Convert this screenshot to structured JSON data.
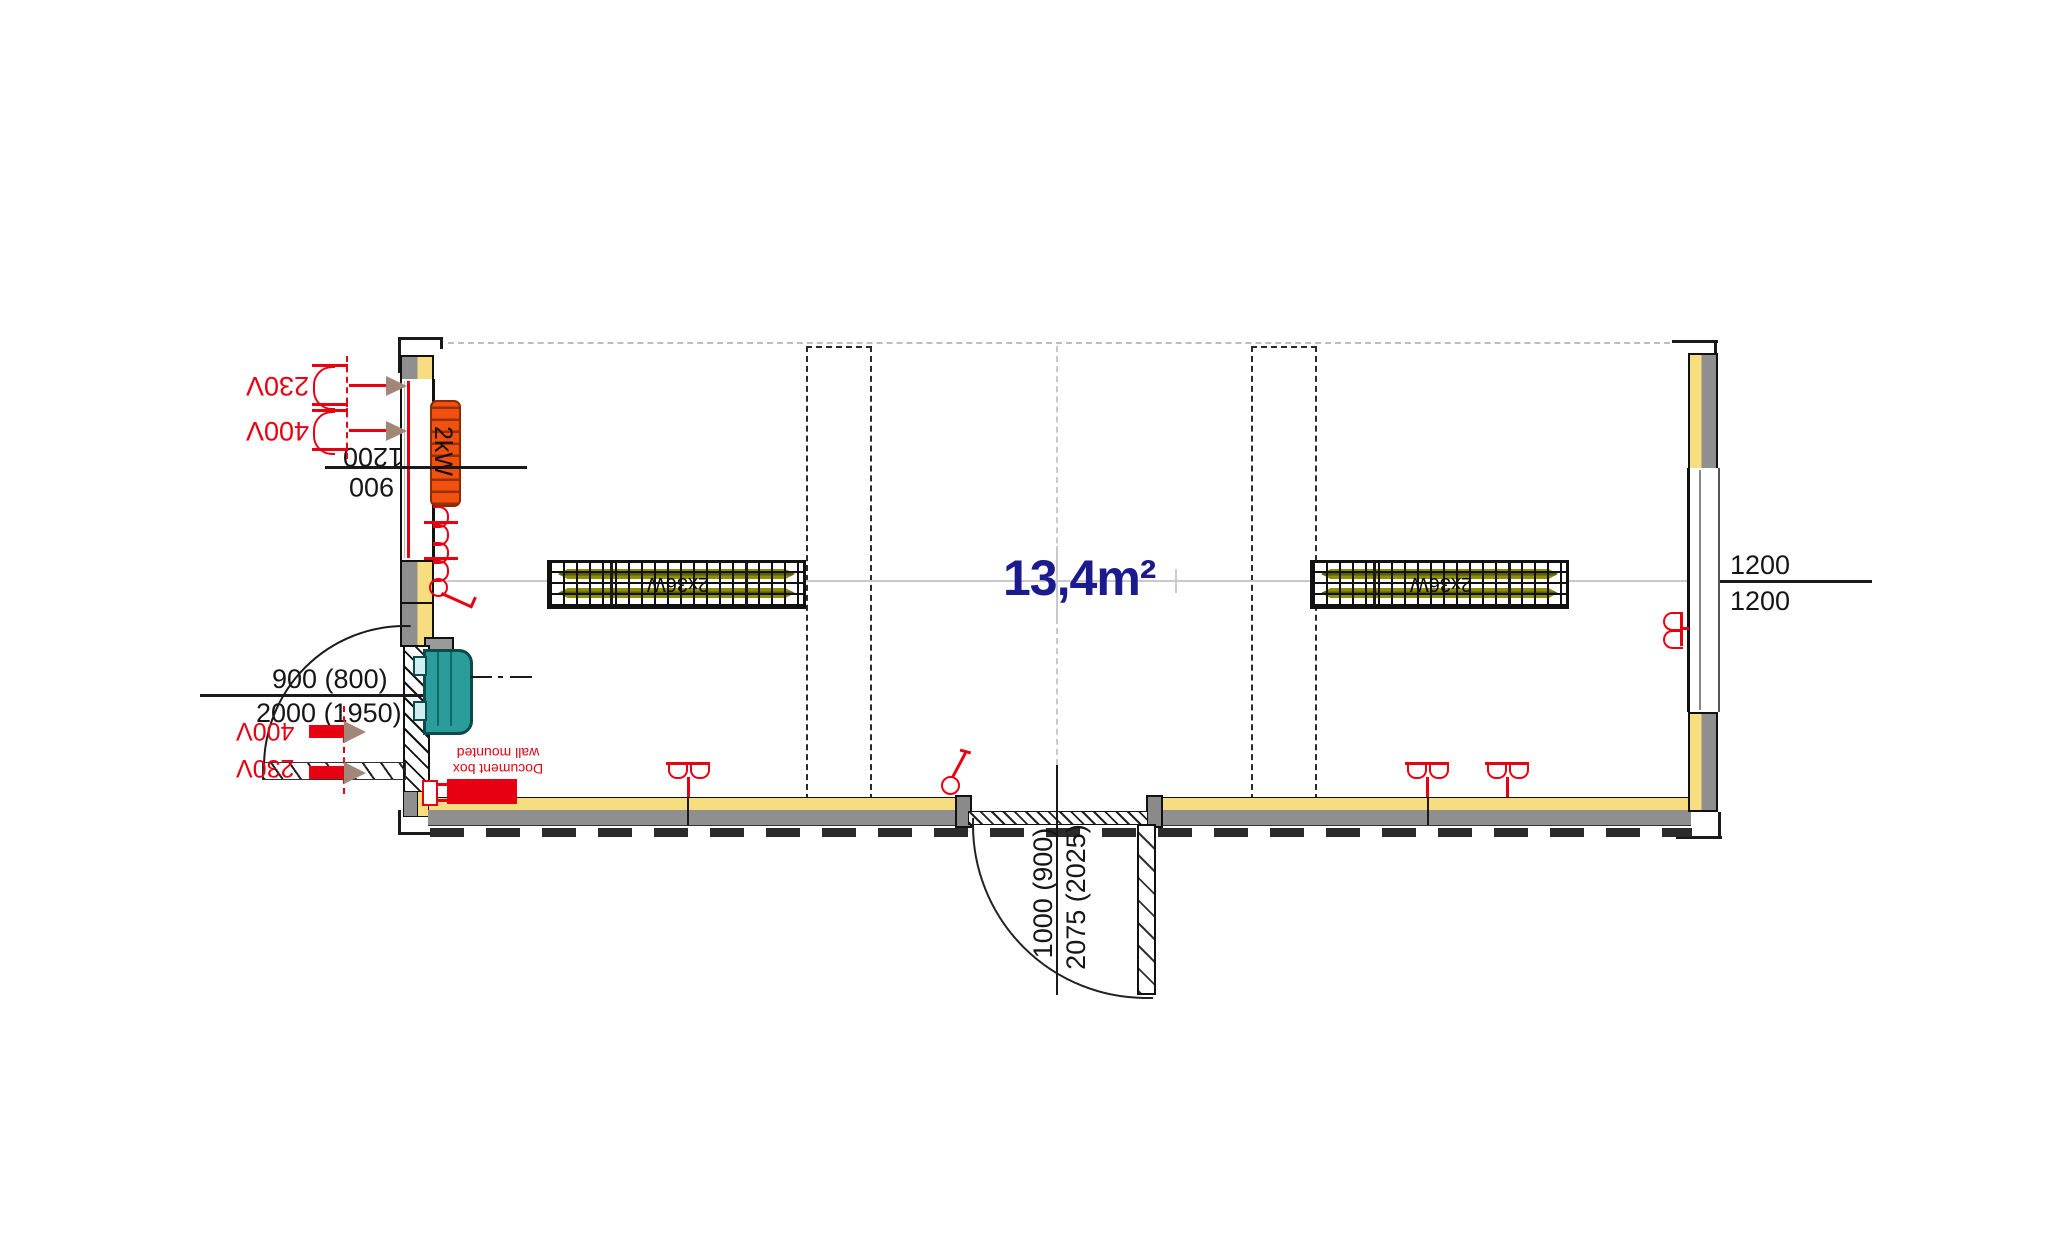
{
  "drawing": {
    "room": {
      "area_label": "13,4m²"
    },
    "luminaires": {
      "left_label": "2x36W",
      "right_label": "2x36W"
    },
    "radiator": {
      "power_label": "2kW",
      "dim_upper": "1200",
      "dim_lower": "900"
    },
    "wall_outlets_top": {
      "outlet_230v": "230V",
      "outlet_400v": "400V"
    },
    "left_door": {
      "dim_width": "900 (800)",
      "dim_height": "2000 (1950)"
    },
    "supply_feeds": {
      "feed_400v": "400V",
      "feed_230v": "230V"
    },
    "document_box": {
      "line1": "Document box",
      "line2": "wall mounted"
    },
    "bottom_door": {
      "dim_width": "1000 (900)",
      "dim_height": "2075 (2025)"
    },
    "right_window": {
      "dim_upper": "1200",
      "dim_lower": "1200"
    }
  },
  "colors": {
    "annotation_red": "#e60012",
    "radiator_orange": "#f2500e",
    "insulation_yellow": "#f6dd7f",
    "wall_gray": "#8f8f8f",
    "unit_teal": "#2b9c9c",
    "area_text_navy": "#1b1b8e",
    "tube_olive": "#8f8f05"
  }
}
